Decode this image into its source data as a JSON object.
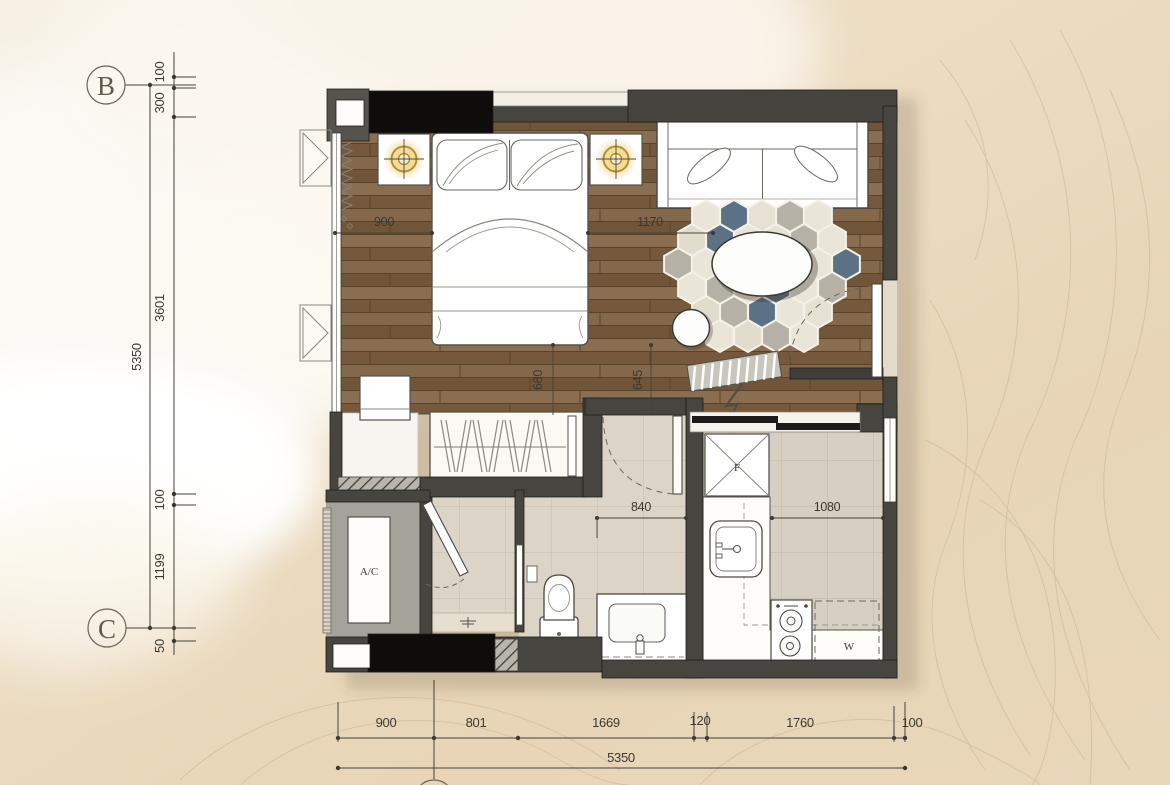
{
  "grid_markers": {
    "top": "B",
    "bottom": "C"
  },
  "labels": {
    "ac": "A/C",
    "fridge": "F",
    "washer": "W"
  },
  "dimensions": {
    "left": {
      "segments": [
        "100",
        "300",
        "3601",
        "100",
        "1199",
        "50"
      ],
      "total": "5350"
    },
    "bottom": {
      "segments": [
        "900",
        "801",
        "1669",
        "120",
        "1760",
        "100"
      ],
      "total": "5350"
    },
    "interior": {
      "bed_side": "900",
      "living_side": "1170",
      "wardrobe_passage": "680",
      "entry_passage": "645",
      "bathroom_width": "840",
      "kitchen_width": "1080"
    }
  },
  "colors": {
    "wood_floor": "#7c6146",
    "tile_floor": "#dcd5c7",
    "wall": "#46453f",
    "column": "#0e0d0b",
    "rug_blue": "#5c7186",
    "rug_grey": "#b6b1a6",
    "rug_cream": "#eae5d9",
    "lamp_gold": "#b8902f",
    "sand": "#e9d7ba",
    "foam": "#faf6ee"
  }
}
